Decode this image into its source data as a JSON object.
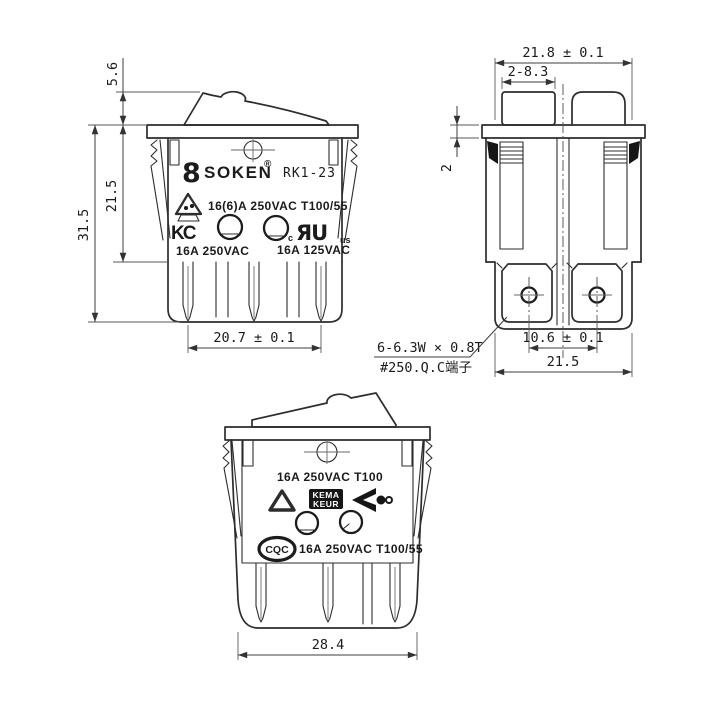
{
  "colors": {
    "background": "#ffffff",
    "line": "#2d2d2d",
    "dimension": "#3d3d3d",
    "text": "#1b1b1b",
    "mark_fill": "#161616"
  },
  "brand": {
    "logo_glyph": "8",
    "name": "SOKEN",
    "registered": "®",
    "model": "RK1-23"
  },
  "front": {
    "dim_rocker_height": "5.6",
    "dim_body_height": "21.5",
    "dim_total_height": "31.5",
    "dim_terminal_span": "20.7 ± 0.1",
    "rating_main": "16(6)A 250VAC T100/55",
    "rating_left": "16A 250VAC",
    "rating_right": "16A 125VAC",
    "kc_mark": "KC",
    "ul_mark": "ЯU",
    "ul_c": "c",
    "ul_us": "us"
  },
  "side": {
    "dim_width_top": "21.8 ± 0.1",
    "dim_rocker_posts": "2-8.3",
    "dim_flange_thickness": "2",
    "dim_hole_span": "10.6 ± 0.1",
    "dim_width_bottom": "21.5",
    "terminal_note_line1": "6-6.3W × 0.8T",
    "terminal_note_line2": "#250.Q.C端子"
  },
  "bottom": {
    "dim_overall_width": "28.4",
    "rating_top": "16A 250VAC T100",
    "rating_bottom": "16A 250VAC T100/55",
    "kema_line1": "KEMA",
    "kema_line2": "KEUR",
    "cqc_mark": "CQC"
  }
}
